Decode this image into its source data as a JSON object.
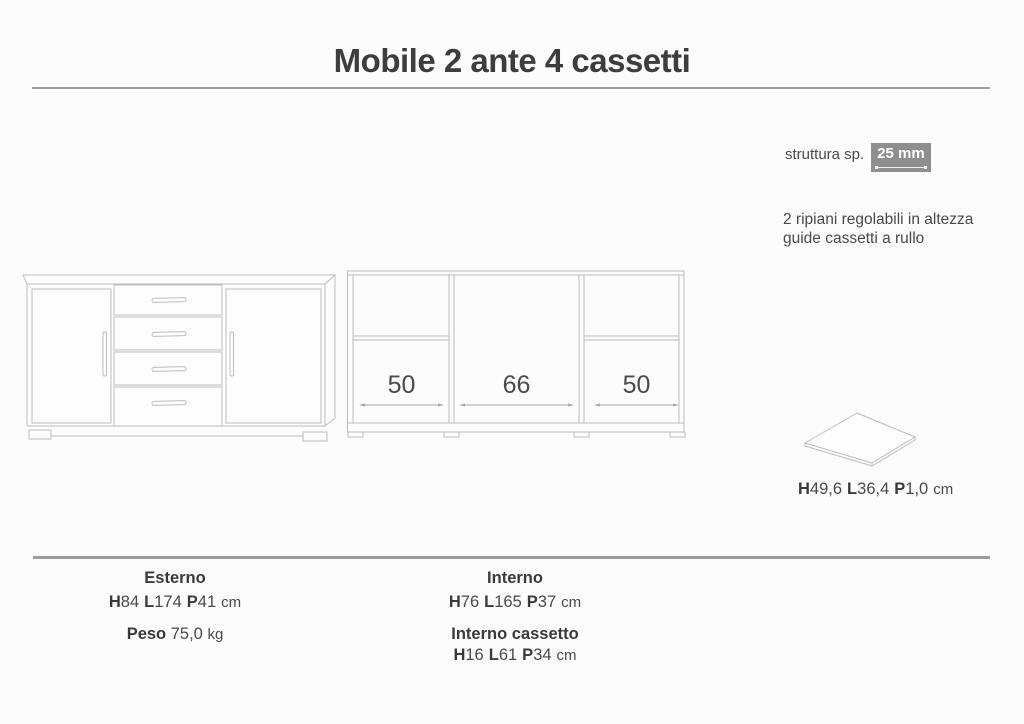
{
  "header": {
    "title": "Mobile 2 ante 4 cassetti"
  },
  "notes": {
    "structure_label": "struttura sp.",
    "structure_value": "25 mm",
    "feature_line1": "2 ripiani regolabili in altezza",
    "feature_line2": "guide cassetti a rullo"
  },
  "dim_letters": {
    "h": "H",
    "l": "L",
    "p": "P"
  },
  "internal_view": {
    "compartment_widths": [
      "50",
      "66",
      "50"
    ]
  },
  "shelf": {
    "h": "49,6",
    "l": "36,4",
    "p": "1,0",
    "unit": "cm"
  },
  "specs": {
    "esterno": {
      "label": "Esterno",
      "h": "84",
      "l": "174",
      "p": "41",
      "unit": "cm"
    },
    "peso": {
      "label": "Peso",
      "value": "75,0",
      "unit": "kg"
    },
    "interno": {
      "label": "Interno",
      "h": "76",
      "l": "165",
      "p": "37",
      "unit": "cm"
    },
    "interno_cassetto": {
      "label": "Interno cassetto",
      "h": "16",
      "l": "61",
      "p": "34",
      "unit": "cm"
    }
  },
  "colors": {
    "line_gray": "#bdbdbd",
    "arrow_gray": "#a6a6a6",
    "text_dark": "#3d3d3d",
    "badge_bg": "#8f8f8f",
    "rule_gray": "#9c9c9c"
  }
}
